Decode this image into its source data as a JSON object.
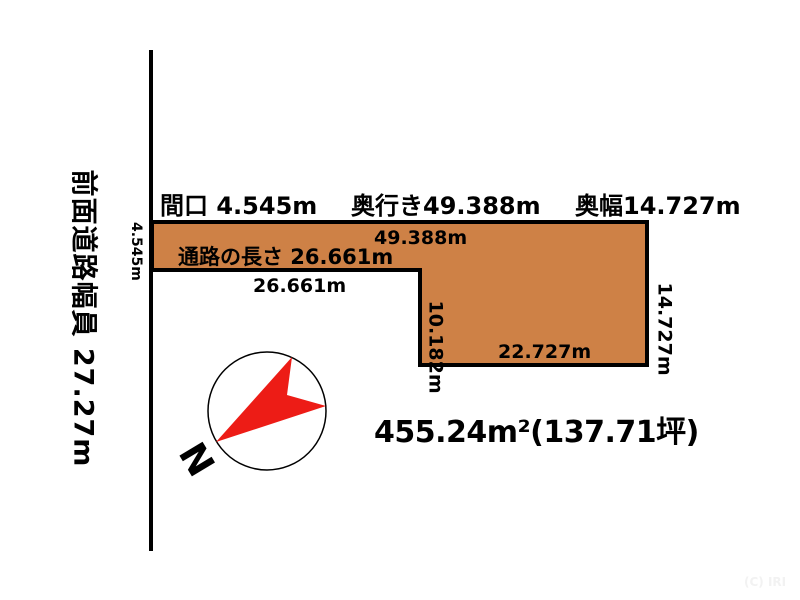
{
  "road": {
    "label": "前面道路幅員 27.27m",
    "frontage_label": "4.545m"
  },
  "header": {
    "frontage": "間口 4.545m",
    "depth": "奥行き49.388m",
    "rear_width": "奥幅14.727m"
  },
  "parcel": {
    "fill_color": "#ce8146",
    "outline_color": "#000000",
    "top_edge_label": "49.388m",
    "corridor_label": "通路の長さ 26.661m",
    "corridor_bottom_label": "26.661m",
    "step_label": "10.182m",
    "bottom_edge_label": "22.727m",
    "right_edge_label": "14.727m"
  },
  "compass": {
    "north_label": "N",
    "needle_color": "#ed1c16"
  },
  "area": {
    "text": "455.24m²(137.71坪)"
  },
  "watermark": {
    "text": "(C) IRI"
  }
}
